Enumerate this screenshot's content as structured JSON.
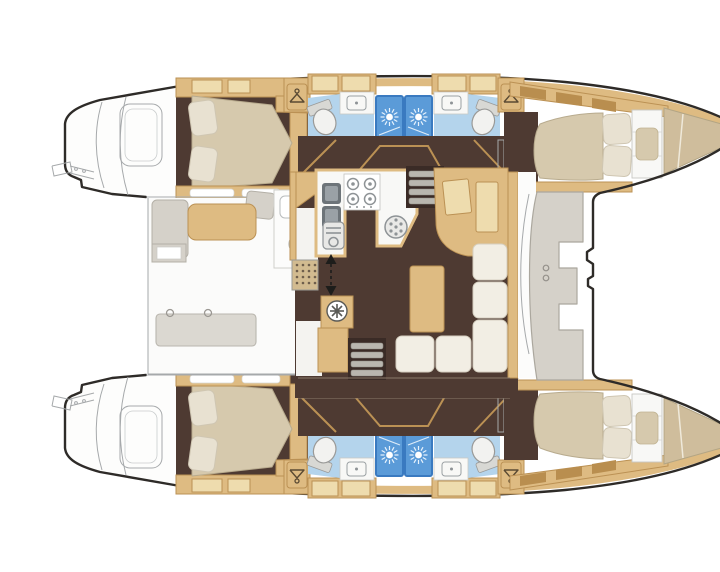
{
  "meta": {
    "title": "Catamaran yacht interior floor plan, top-down view, bow to the right",
    "type": "boat-deck-plan",
    "text_on_image": ""
  },
  "palette": {
    "outline": "#2e2b28",
    "sketch": "#a6a9ab",
    "wood": "#debb82",
    "woodDark": "#bb9154",
    "woodLight": "#eedcae",
    "woodDeep": "#b98e4f",
    "floor": "#4e3a32",
    "floorDark": "#3a2b26",
    "mattress": "#d6c9ad",
    "bowDeck": "#cfbd9c",
    "pillow": "#e8e1d1",
    "cushion": "#d5d1c9",
    "cushionDark": "#b4b0a7",
    "bathFloor": "#b4d4ec",
    "shower": "#5b9bd8",
    "showerDark": "#3a7ac0",
    "fixture": "#f8f8f6",
    "steel": "#8e9396",
    "steelDark": "#6c7378",
    "matBg": "#d2bb90",
    "matDot": "#6e5e4c",
    "paper": "#ffffff",
    "tableGray": "#dbd8d1"
  },
  "regions": [
    {
      "name": "port-swim-platform"
    },
    {
      "name": "port-aft-cabin"
    },
    {
      "name": "port-aft-head"
    },
    {
      "name": "port-forward-head"
    },
    {
      "name": "port-forward-cabin"
    },
    {
      "name": "port-bow-locker"
    },
    {
      "name": "starboard-swim-platform"
    },
    {
      "name": "starboard-aft-cabin"
    },
    {
      "name": "starboard-aft-head"
    },
    {
      "name": "starboard-forward-head"
    },
    {
      "name": "starboard-forward-cabin"
    },
    {
      "name": "starboard-bow-locker"
    },
    {
      "name": "aft-cockpit"
    },
    {
      "name": "galley"
    },
    {
      "name": "salon-dinette"
    },
    {
      "name": "nav-station"
    },
    {
      "name": "forward-cockpit"
    },
    {
      "name": "trampoline"
    }
  ],
  "icons": [
    "shower-head-sunburst",
    "coat-hanger",
    "toilet",
    "sink-basin",
    "double-sink",
    "oven",
    "stove-burners",
    "round-sink",
    "companionway-arrow",
    "companionway-steps",
    "washer-wheel",
    "cockpit-round-sink",
    "entry-mat"
  ]
}
